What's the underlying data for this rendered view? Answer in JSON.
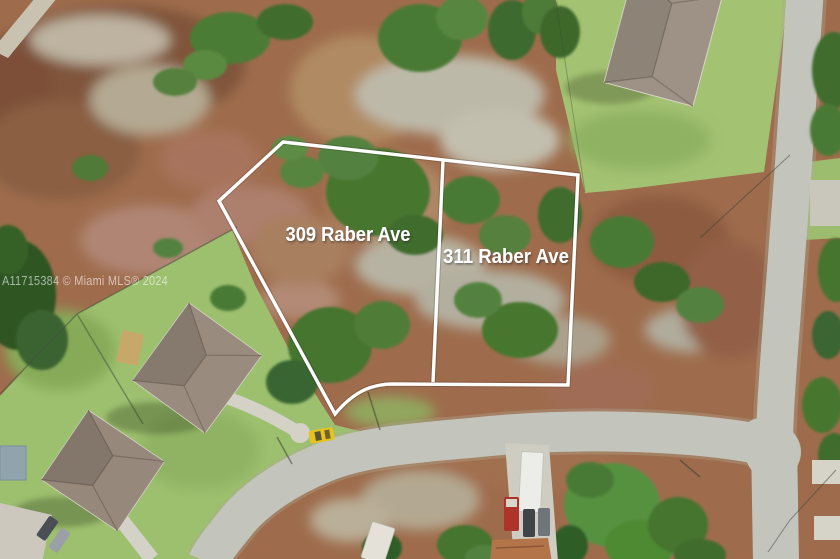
{
  "photo": {
    "lot_labels": [
      {
        "id": "lot-309",
        "label": "309 Raber Ave"
      },
      {
        "id": "lot-311",
        "label": "311 Raber Ave"
      }
    ],
    "watermark": "A11715384 © Miami MLS® 2024",
    "colors": {
      "boundary_line": "#ffffff",
      "label_text": "#ffffff",
      "watermark_text": "#ffffff",
      "yellow_car": "#e6c31d"
    }
  }
}
